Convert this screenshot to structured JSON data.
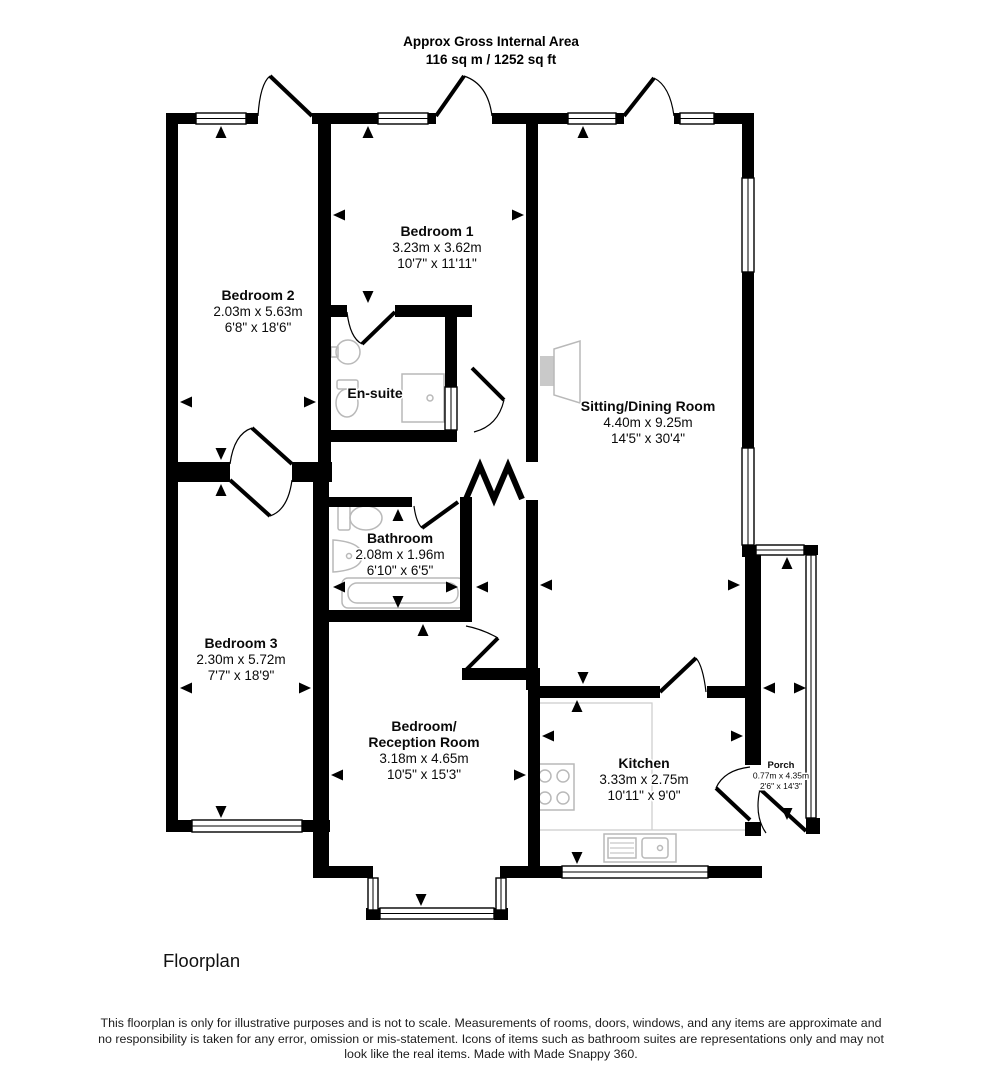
{
  "header": {
    "title": "Approx Gross Internal Area",
    "area": "116 sq m / 1252 sq ft"
  },
  "floorplan": {
    "rooms": [
      {
        "id": "bedroom-1",
        "lines": [
          "Bedroom 1"
        ],
        "metric": "3.23m x 3.62m",
        "imperial": "10'7\" x 11'11\"",
        "x": 437,
        "y": 236
      },
      {
        "id": "bedroom-2",
        "lines": [
          "Bedroom 2"
        ],
        "metric": "2.03m x 5.63m",
        "imperial": "6'8\" x 18'6\"",
        "x": 258,
        "y": 300
      },
      {
        "id": "en-suite",
        "lines": [
          "En-suite"
        ],
        "metric": "",
        "imperial": "",
        "x": 375,
        "y": 398
      },
      {
        "id": "sitting-dining-room",
        "lines": [
          "Sitting/Dining Room"
        ],
        "metric": "4.40m x 9.25m",
        "imperial": "14'5\" x 30'4\"",
        "x": 648,
        "y": 411
      },
      {
        "id": "bathroom",
        "lines": [
          "Bathroom"
        ],
        "metric": "2.08m x 1.96m",
        "imperial": "6'10\" x 6'5\"",
        "x": 400,
        "y": 543
      },
      {
        "id": "bedroom-3",
        "lines": [
          "Bedroom 3"
        ],
        "metric": "2.30m x 5.72m",
        "imperial": "7'7\" x 18'9\"",
        "x": 241,
        "y": 648
      },
      {
        "id": "bedroom-reception-room",
        "lines": [
          "Bedroom/",
          "Reception Room"
        ],
        "metric": "3.18m x 4.65m",
        "imperial": "10'5\" x 15'3\"",
        "x": 424,
        "y": 731
      },
      {
        "id": "kitchen",
        "lines": [
          "Kitchen"
        ],
        "metric": "3.33m x 2.75m",
        "imperial": "10'11\" x 9'0\"",
        "x": 644,
        "y": 768
      },
      {
        "id": "porch",
        "lines": [
          "Porch"
        ],
        "metric": "0.77m x 4.35m",
        "imperial": "2'6\" x 14'3\"",
        "x": 781,
        "y": 768,
        "small": true
      }
    ]
  },
  "footer": {
    "caption": "Floorplan",
    "disclaimer": "This floorplan is only for illustrative purposes and is not to scale. Measurements of rooms, doors, windows, and any items are approximate and no responsibility is taken for any error, omission or mis-statement. Icons of items such as bathroom suites are representations only and may not look like the real items. Made with Made Snappy 360."
  },
  "colors": {
    "wall": "#000000",
    "text": "#0a0a0a",
    "fixture": "#b9b9b9",
    "fireplace_fill": "#c9c9c9",
    "counter": "#cccccc"
  }
}
